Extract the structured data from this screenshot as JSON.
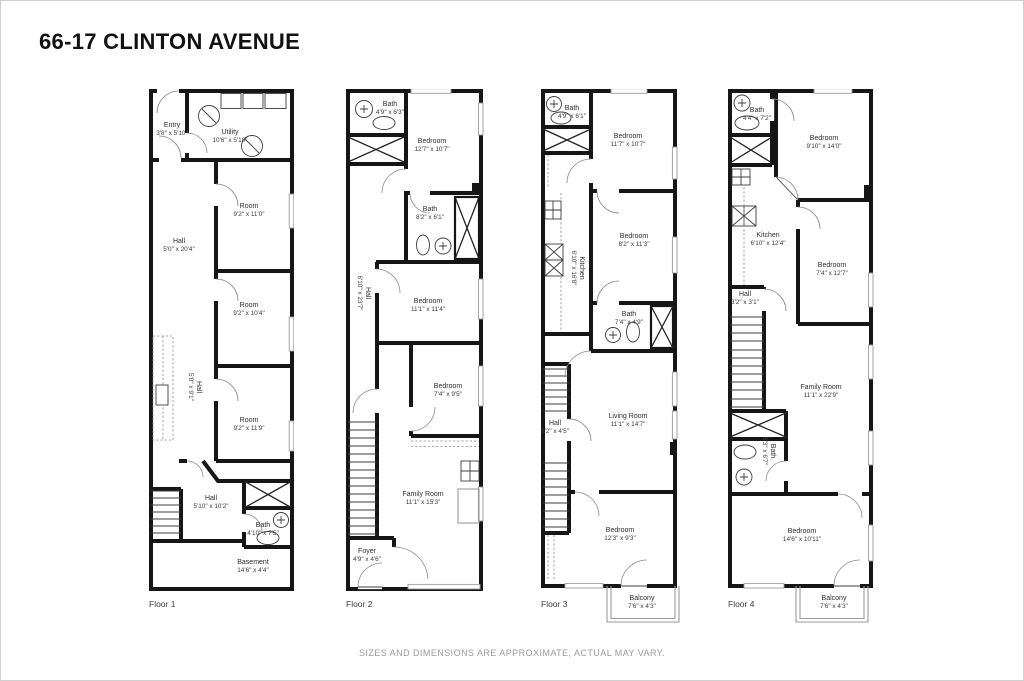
{
  "title": "66-17 CLINTON AVENUE",
  "disclaimer": "SIZES AND DIMENSIONS ARE APPROXIMATE, ACTUAL MAY VARY.",
  "colors": {
    "wall": "#161616",
    "muted_gray": "#9a9a9a",
    "text": "#2e2e2e"
  },
  "floors": [
    {
      "label": "Floor 1",
      "rooms": [
        {
          "name": "Entry",
          "dims": "3'8\" x 5'10\""
        },
        {
          "name": "Utility",
          "dims": "10'6\" x 5'10\""
        },
        {
          "name": "Room",
          "dims": "9'2\" x 11'0\""
        },
        {
          "name": "Hall",
          "dims": "5'0\" x 20'4\""
        },
        {
          "name": "Room",
          "dims": "9'2\" x 10'4\""
        },
        {
          "name": "Room",
          "dims": "9'2\" x 11'9\""
        },
        {
          "name": "Hall",
          "dims": "5'0\" x 9'1\""
        },
        {
          "name": "Hall",
          "dims": "5'10\" x 10'2\""
        },
        {
          "name": "Bath",
          "dims": "4'10\" x 7'5\""
        },
        {
          "name": "Basement",
          "dims": "14'6\" x 4'4\""
        }
      ]
    },
    {
      "label": "Floor 2",
      "rooms": [
        {
          "name": "Bath",
          "dims": "4'9\" x 6'3\""
        },
        {
          "name": "Bedroom",
          "dims": "12'7\" x 10'7\""
        },
        {
          "name": "Bath",
          "dims": "8'2\" x 6'1\""
        },
        {
          "name": "Hall",
          "dims": "6'10\" x 23'7\""
        },
        {
          "name": "Bedroom",
          "dims": "11'1\" x 11'4\""
        },
        {
          "name": "Bedroom",
          "dims": "7'4\" x 9'5\""
        },
        {
          "name": "Family Room",
          "dims": "11'1\" x 15'3\""
        },
        {
          "name": "Foyer",
          "dims": "4'9\" x 4'6\""
        }
      ]
    },
    {
      "label": "Floor 3",
      "rooms": [
        {
          "name": "Bath",
          "dims": "4'9\" x 6'1\""
        },
        {
          "name": "Bedroom",
          "dims": "11'7\" x 10'7\""
        },
        {
          "name": "Kitchen",
          "dims": "6'10\" x 16'8\""
        },
        {
          "name": "Bedroom",
          "dims": "8'2\" x 11'3\""
        },
        {
          "name": "Bath",
          "dims": "7'4\" x 4'9\""
        },
        {
          "name": "Hall",
          "dims": "3'2\" x 4'5\""
        },
        {
          "name": "Living Room",
          "dims": "11'1\" x 14'7\""
        },
        {
          "name": "Bedroom",
          "dims": "12'3\" x 9'3\""
        },
        {
          "name": "Balcony",
          "dims": "7'6\" x 4'3\""
        }
      ]
    },
    {
      "label": "Floor 4",
      "rooms": [
        {
          "name": "Bath",
          "dims": "4'4\" x 7'2\""
        },
        {
          "name": "Bedroom",
          "dims": "9'10\" x 14'0\""
        },
        {
          "name": "Kitchen",
          "dims": "6'10\" x 12'4\""
        },
        {
          "name": "Bedroom",
          "dims": "7'4\" x 12'7\""
        },
        {
          "name": "Hall",
          "dims": "3'2\" x 3'1\""
        },
        {
          "name": "Bath",
          "dims": "5'3\" x 6'7\""
        },
        {
          "name": "Family Room",
          "dims": "11'1\" x 22'9\""
        },
        {
          "name": "Bedroom",
          "dims": "14'6\" x 10'11\""
        },
        {
          "name": "Balcony",
          "dims": "7'6\" x 4'3\""
        }
      ]
    }
  ]
}
